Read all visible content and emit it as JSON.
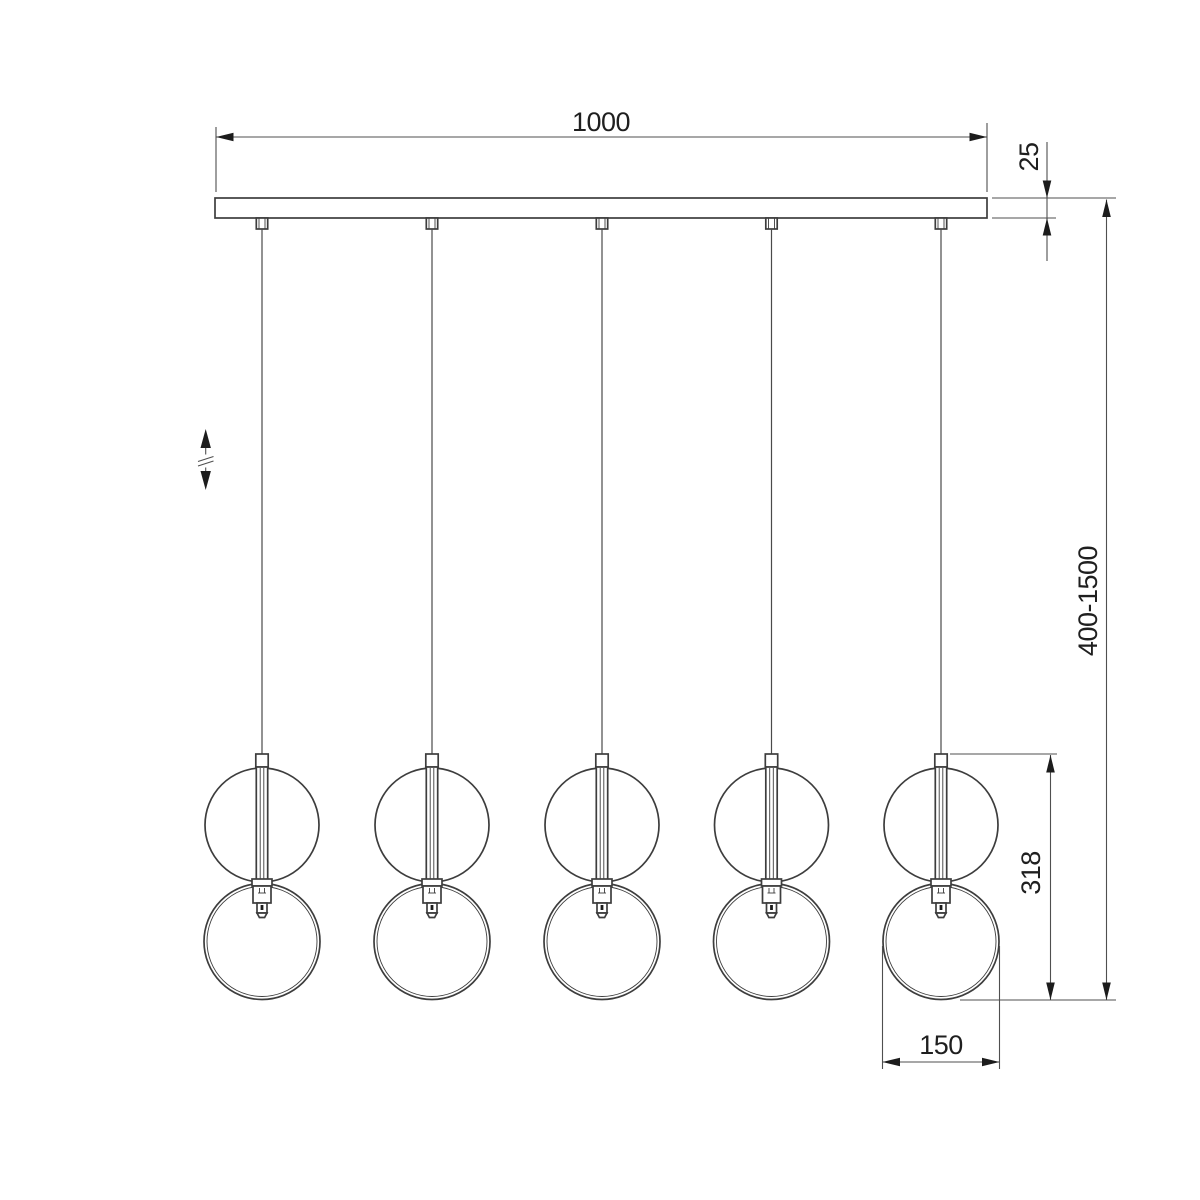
{
  "meta": {
    "title": "Linear pendant chandelier - dimensional drawing",
    "drawing_style": "technical line drawing",
    "background": "#ffffff"
  },
  "colors": {
    "object_line": "#3d3d3d",
    "dimension_line": "#4f4f4f",
    "text": "#1f1f1f"
  },
  "fixture": {
    "pendant_count": 5,
    "parts": [
      "ceiling-plate",
      "cable-gland",
      "suspension-cable",
      "cord-connector",
      "glass-sphere",
      "center-rod",
      "lamp-holder",
      "socket",
      "bottom-ring"
    ]
  },
  "dimensions": {
    "canopy_length": {
      "value": "1000",
      "orientation": "horizontal",
      "location": "top, length of ceiling plate"
    },
    "canopy_thickness": {
      "value": "25",
      "orientation": "vertical",
      "location": "right of ceiling plate"
    },
    "suspension_range": {
      "value": "400-1500",
      "orientation": "vertical",
      "location": "far right, adjustable drop"
    },
    "pendant_height": {
      "value": "318",
      "orientation": "vertical",
      "location": "right of last pendant"
    },
    "ring_diameter": {
      "value": "150",
      "orientation": "horizontal",
      "location": "below last pendant ring"
    }
  },
  "icons": {
    "height_adjust": "up-down-arrows-with-break"
  }
}
